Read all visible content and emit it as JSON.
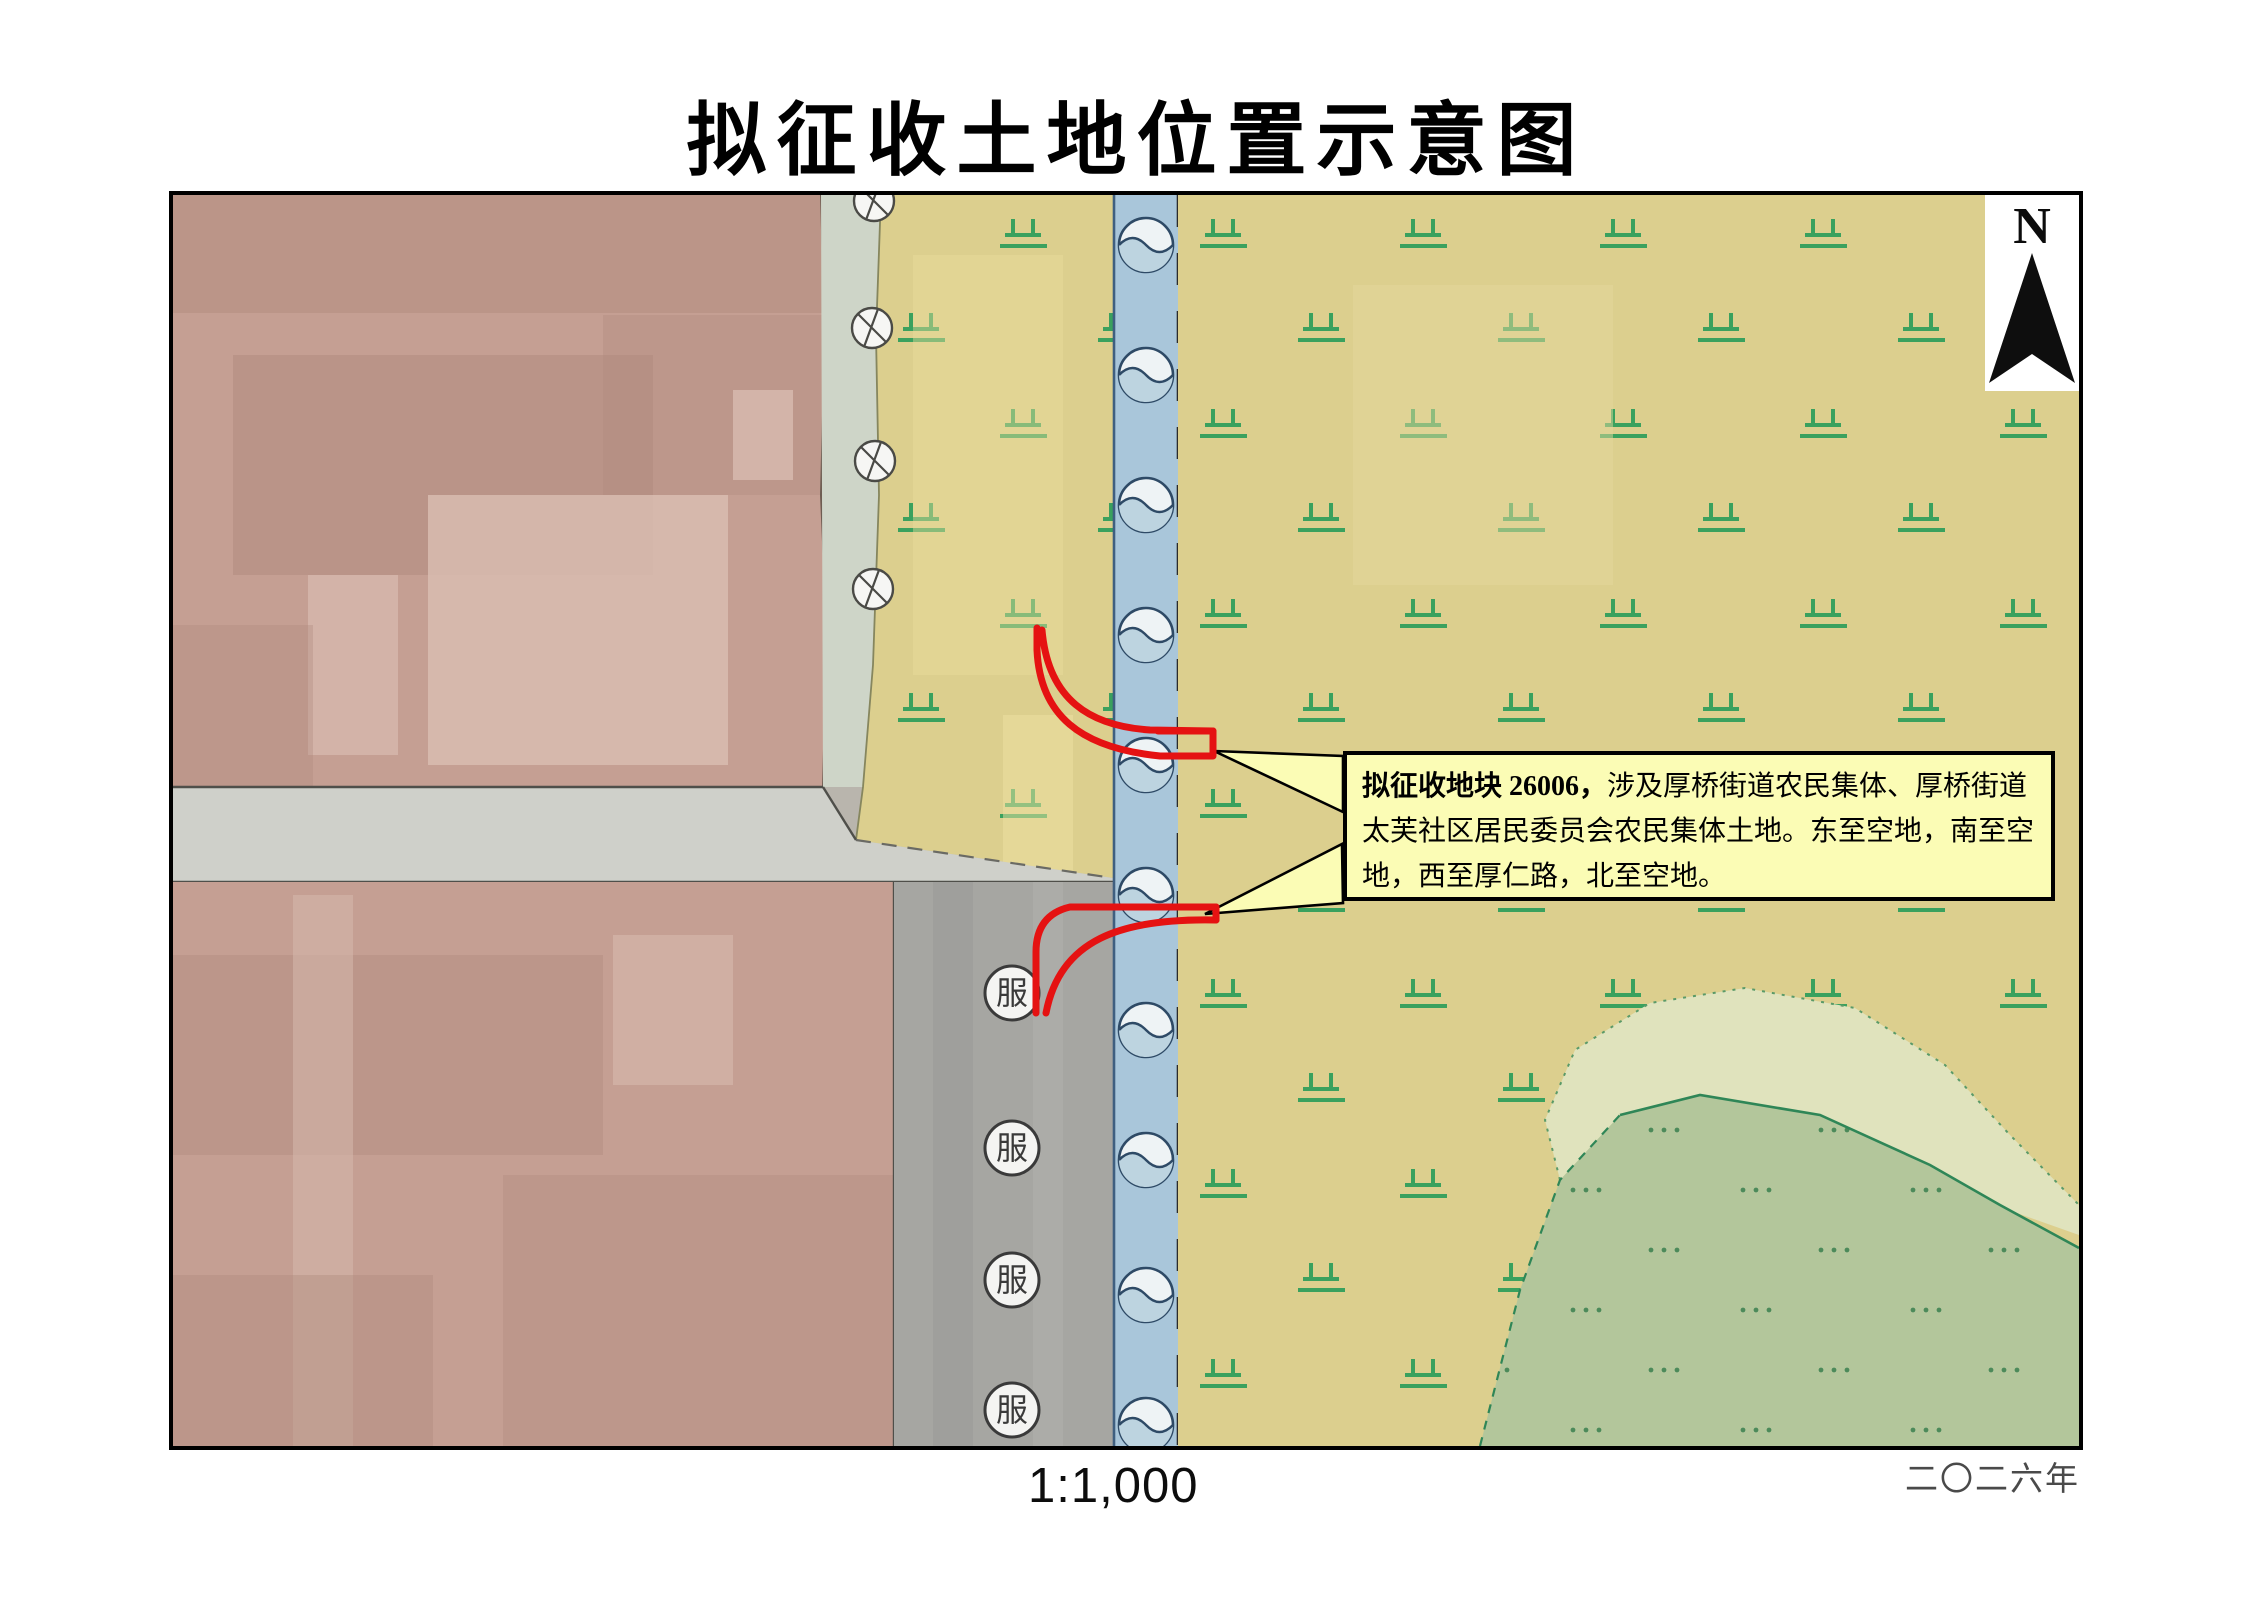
{
  "page": {
    "title": "拟征收土地位置示意图"
  },
  "map": {
    "scale_label": "1:1,000",
    "year_label": "二〇二六年",
    "north_label": "N",
    "service_symbol_label": "服",
    "annotation": {
      "bold": "拟征收地块 26006，",
      "body": "涉及厚桥街道农民集体、厚桥街道太芙社区居民委员会农民集体土地。东至空地，南至空地，西至厚仁路，北至空地。"
    },
    "parcel_id": "26006"
  },
  "colors": {
    "parcelRed": "#e51212",
    "boxBg": "#fbfcb5",
    "calloutFill": "#fbfcb5",
    "yellow": "#dccf8e",
    "river": "#a9c6da",
    "pink": "#c59f93",
    "celadon": "#ced5c8",
    "roadH": "#cfd0ca",
    "roadV": "#a6a6a2",
    "greenArea": "#b3c69b",
    "palePatch": "#e0e3bd",
    "symGreen": "#3aa15e",
    "dateColor": "#4a4a4a"
  }
}
